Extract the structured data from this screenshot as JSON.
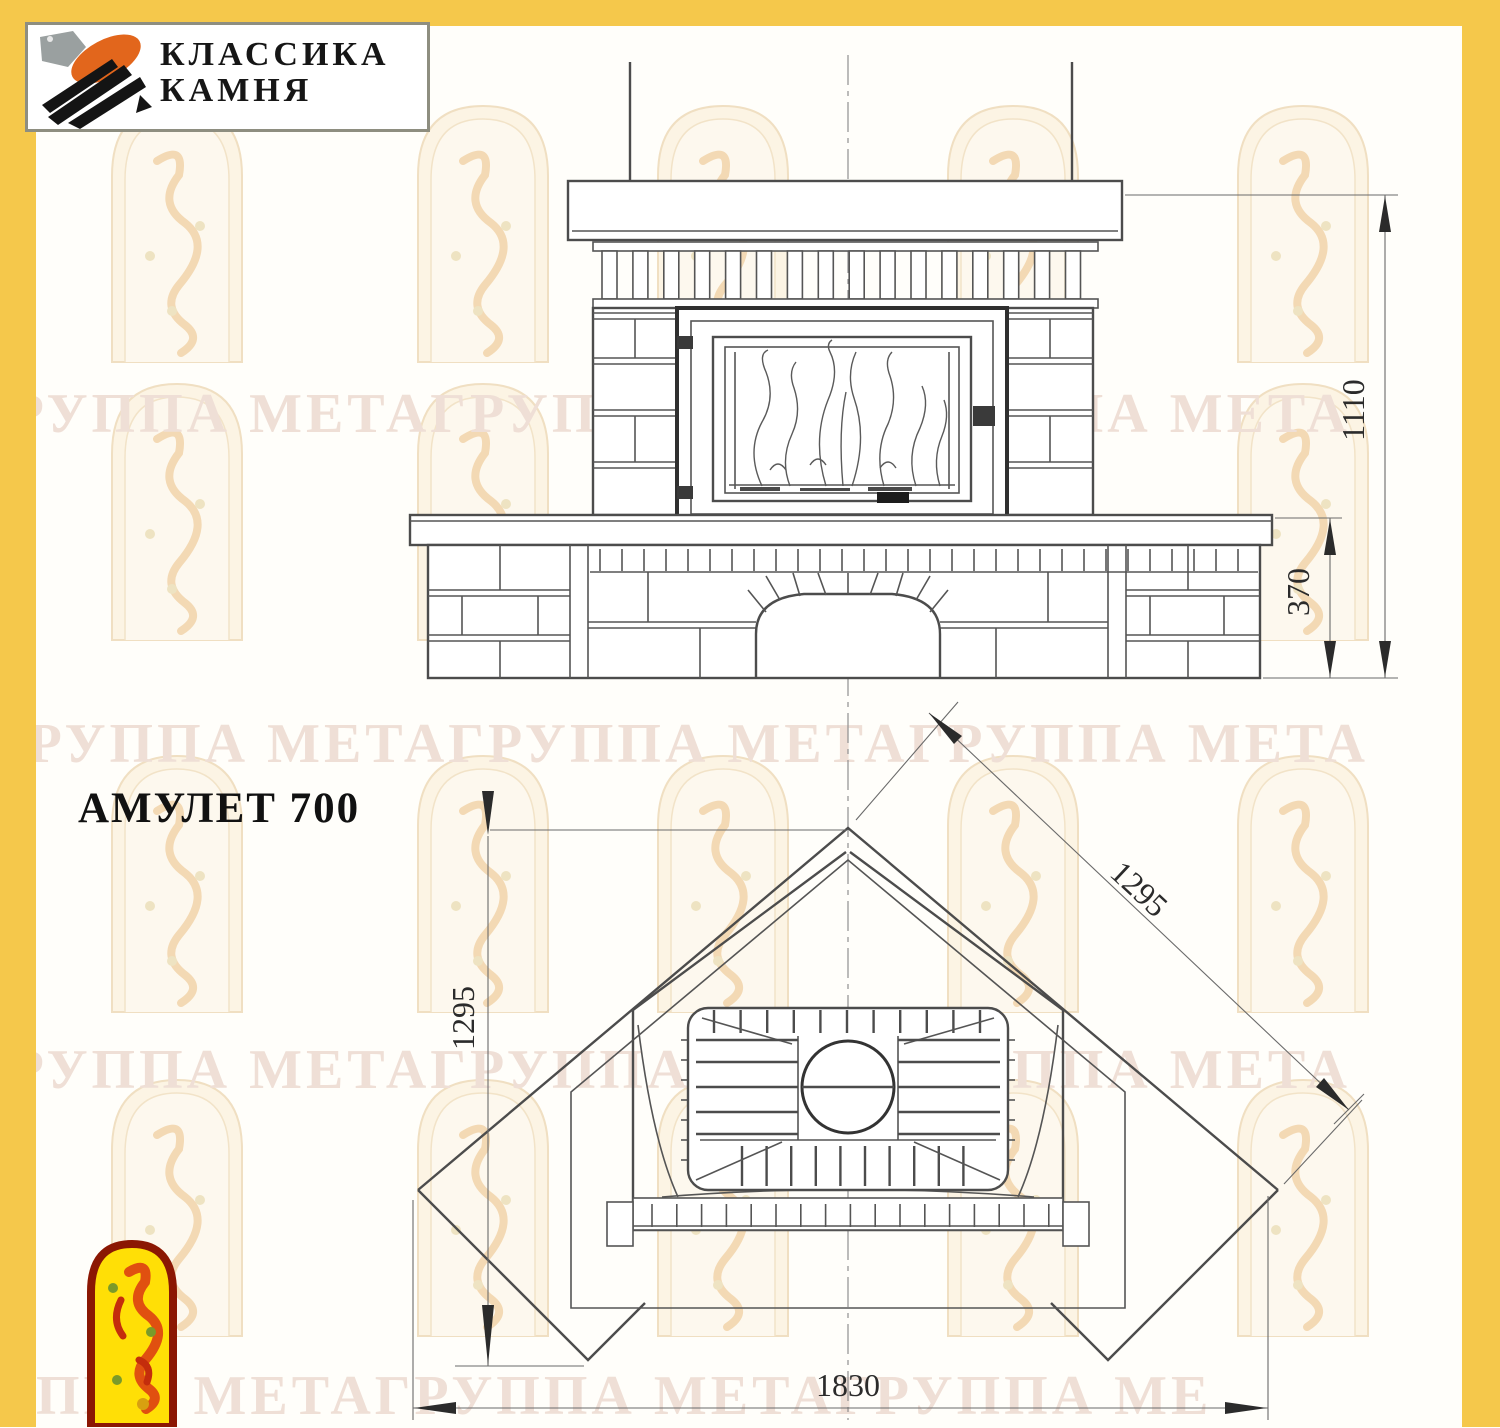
{
  "brand": {
    "line1": "КЛАССИКА",
    "line2": "КАМНЯ"
  },
  "title": "АМУЛЕТ 700",
  "dims": {
    "overall_height": "1110",
    "hearth_height": "370",
    "side_left": "1295",
    "side_right": "1295",
    "front_width": "1830"
  },
  "watermark": {
    "rows": [
      "ГРУППА МЕТАГРУППА МЕТАГРУППА МЕТА",
      "ГРУППА МЕТАГРУППА МЕТАГРУППА МЕТА",
      "ГРУППА МЕТАГРУППА МЕТАГРУППА МЕТА",
      "ППА МЕТАГРУППА МЕТАГРУППА МЕ"
    ]
  },
  "colors": {
    "frame_yellow": "#F5C84B",
    "logo_orange": "#E2661C",
    "badge_red": "#8B1703",
    "badge_yellow": "#FFDF06"
  }
}
